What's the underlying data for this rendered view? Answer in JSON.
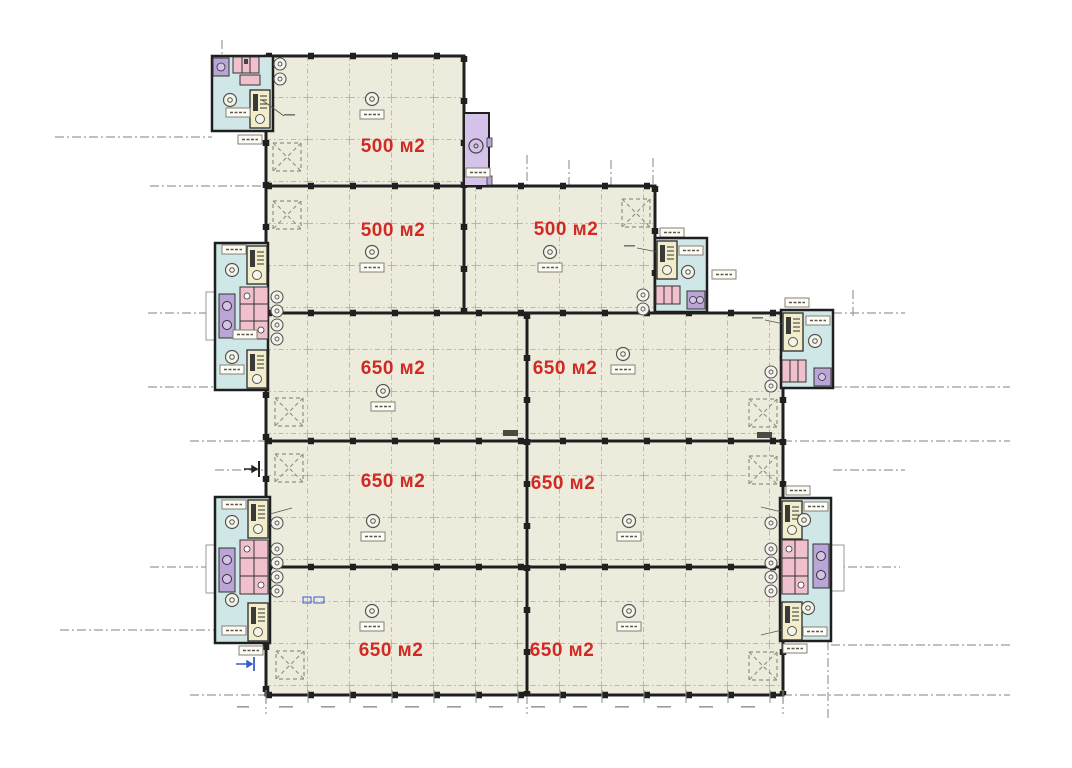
{
  "document": {
    "kind": "architectural floor plan (industrial building storey)",
    "background_color": "#ffffff"
  },
  "plan": {
    "rooms": [
      {
        "name": "hall-top",
        "area": "500 м2"
      },
      {
        "name": "hall-row2-left",
        "area": "500 м2"
      },
      {
        "name": "hall-row2-right",
        "area": "500 м2"
      },
      {
        "name": "hall-row3-left",
        "area": "650 м2"
      },
      {
        "name": "hall-row3-right",
        "area": "650 м2"
      },
      {
        "name": "hall-row4-left",
        "area": "650 м2"
      },
      {
        "name": "hall-row4-right",
        "area": "650 м2"
      },
      {
        "name": "hall-row5-left",
        "area": "650 м2"
      },
      {
        "name": "hall-row5-right",
        "area": "650 м2"
      }
    ],
    "cores": [
      "stair-wc-core-top-left",
      "stair-wc-core-left-middle",
      "stair-wc-core-left-bottom",
      "stair-wc-core-row2-right",
      "stair-wc-core-right-middle",
      "stair-wc-core-right-bottom"
    ],
    "elevator_count": 1,
    "colors": {
      "floor": "#edebdc",
      "walls": "#1f1f1f",
      "core_room": "#cfe8e7",
      "stair": "#f2edcb",
      "elevator": "#d5c2e8",
      "fixture_pink": "#f0c0cc",
      "fixture_purple": "#b9a6d6",
      "area_label": "#cf2b24",
      "grid": "#b7b7aa",
      "axis": "#9a9a97",
      "section_marker": "#3a5bd0"
    }
  }
}
